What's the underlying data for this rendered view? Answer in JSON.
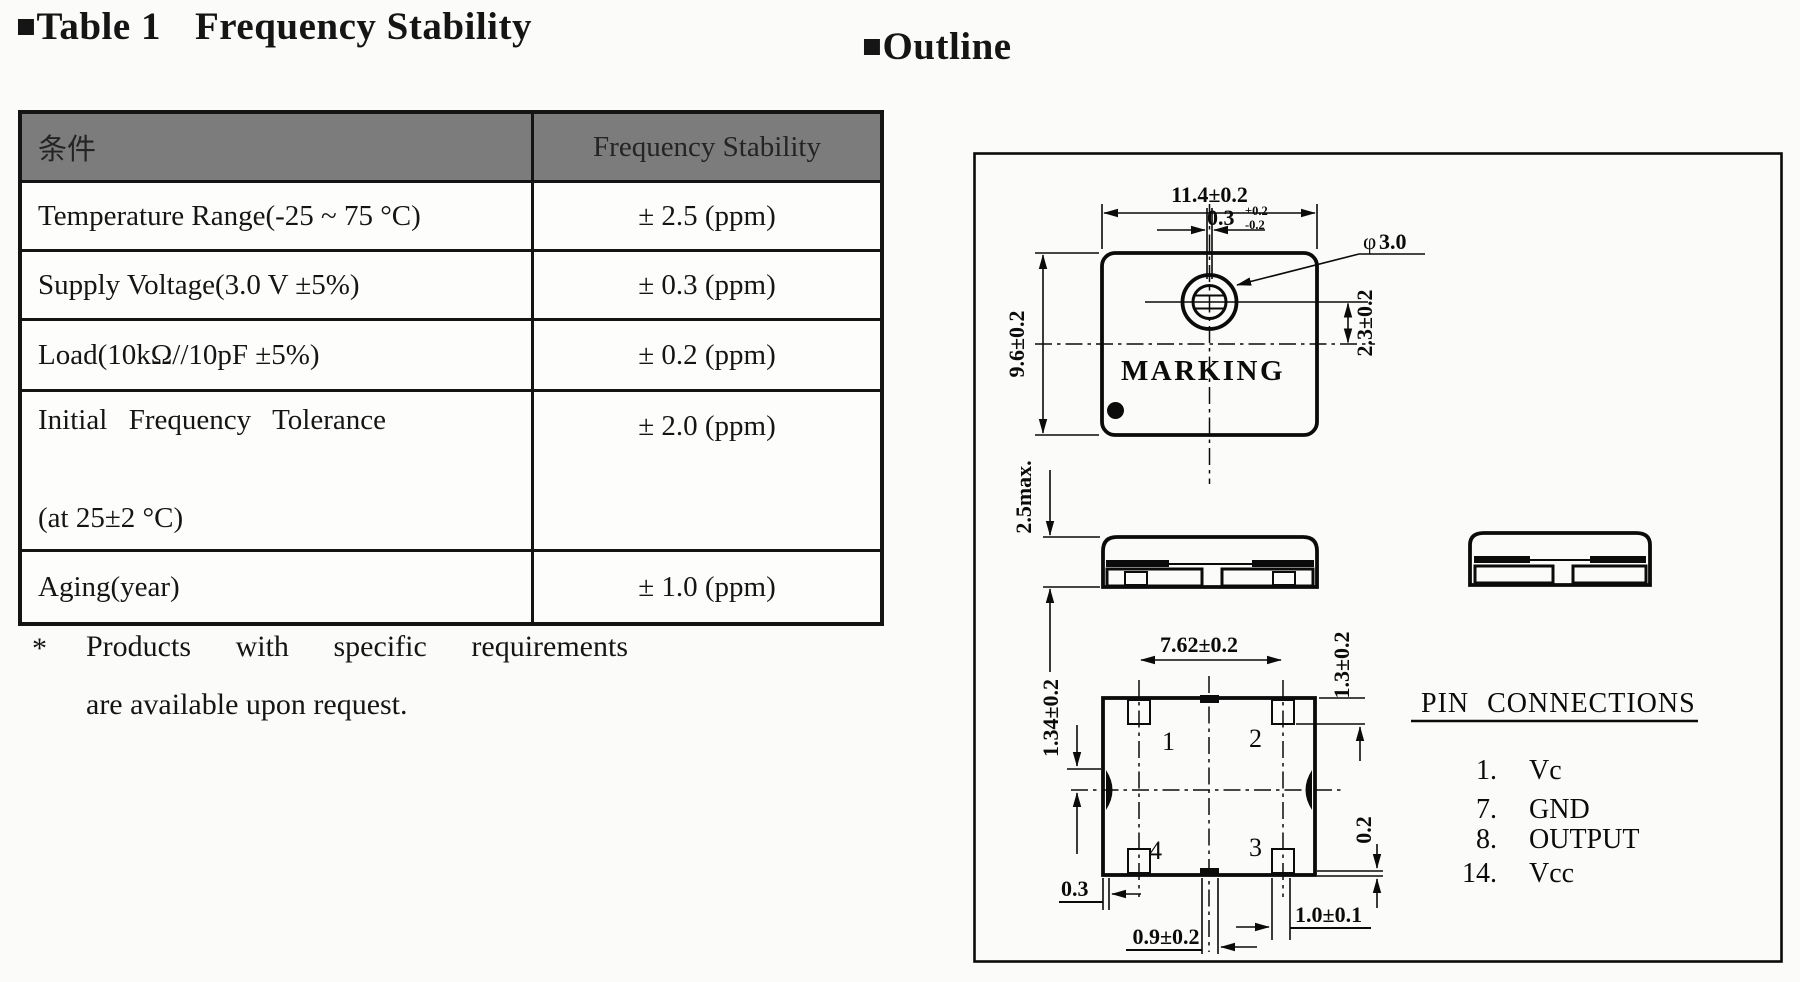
{
  "page": {
    "background": "#fbfbfa",
    "ink": "#151515",
    "header_bg": "#7c7c7c"
  },
  "table_section": {
    "title": {
      "marker": "■",
      "text": "Table 1",
      "text2": "Frequency Stability"
    },
    "header": {
      "col1": "条件",
      "col2": "Frequency Stability"
    },
    "rows": [
      {
        "c1": "Temperature Range(-25 ~ 75 °C)",
        "c2": "± 2.5 (ppm)"
      },
      {
        "c1": "Supply Voltage(3.0 V ±5%)",
        "c2": "± 0.3 (ppm)"
      },
      {
        "c1": "Load(10kΩ//10pF ±5%)",
        "c2": "± 0.2 (ppm)"
      },
      {
        "c1": "Initial Frequency Tolerance",
        "c1b": "(at 25±2 °C)",
        "c2": "± 2.0 (ppm)"
      },
      {
        "c1": "Aging(year)",
        "c2": "± 1.0 (ppm)"
      }
    ],
    "footnote": {
      "marker": "*",
      "line1": "Products with specific requirements",
      "line2": "are available upon request."
    }
  },
  "outline_section": {
    "title": {
      "marker": "■",
      "text": "Outline"
    },
    "top_view": {
      "marking": "MARKING",
      "dim_width": "11.4±0.2",
      "dim_slot": "0.3",
      "dim_slot_tol_up": "+0.2",
      "dim_slot_tol_dn": "-0.2",
      "dim_hole_phi": "φ",
      "dim_hole_dia": "3.0",
      "dim_height": "9.6±0.2",
      "dim_hole_offset": "2.3±0.2"
    },
    "side_view": {
      "dim_height": "2.5max."
    },
    "bottom_view": {
      "dim_pad_pitch": "7.62±0.2",
      "dim_pad_length": "1.3±0.2",
      "dim_pad_side": "1.34±0.2",
      "dim_edge_gap": "0.3",
      "dim_center_notch": "0.9±0.2",
      "dim_pad_width": "1.0±0.1",
      "dim_bottom_step": "0.2",
      "pad1": "1",
      "pad2": "2",
      "pad3": "3",
      "pad4": "4"
    },
    "pin_connections": {
      "title": "PIN CONNECTIONS",
      "pins": [
        {
          "num": "1.",
          "name": "Vc"
        },
        {
          "num": "7.",
          "name": "GND"
        },
        {
          "num": "8.",
          "name": "OUTPUT"
        },
        {
          "num": "14.",
          "name": "Vcc"
        }
      ]
    }
  }
}
